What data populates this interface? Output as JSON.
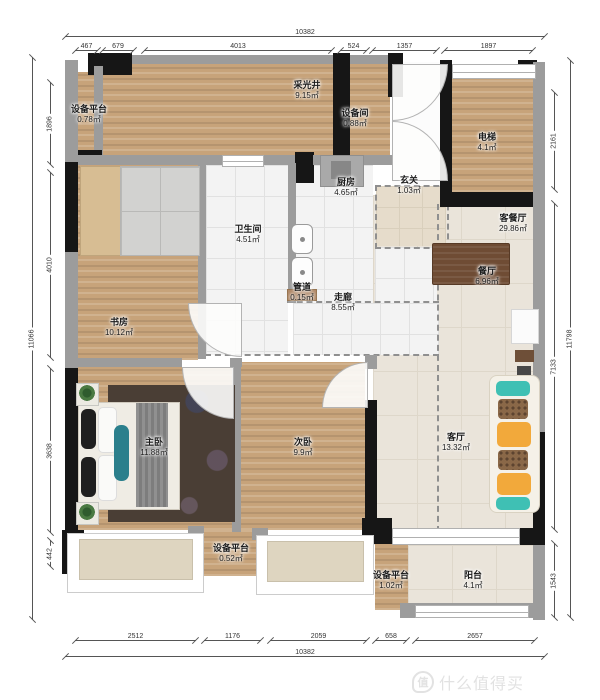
{
  "rooms": [
    {
      "key": "equip_platform_tl",
      "name": "设备平台",
      "area": "0.78㎡"
    },
    {
      "key": "light_well",
      "name": "采光井",
      "area": "9.15㎡"
    },
    {
      "key": "equip_room",
      "name": "设备间",
      "area": "0.88㎡"
    },
    {
      "key": "elevator",
      "name": "电梯",
      "area": "4.1㎡"
    },
    {
      "key": "kitchen",
      "name": "厨房",
      "area": "4.65㎡"
    },
    {
      "key": "entry",
      "name": "玄关",
      "area": "1.03㎡"
    },
    {
      "key": "bathroom",
      "name": "卫生间",
      "area": "4.51㎡"
    },
    {
      "key": "living_dining",
      "name": "客餐厅",
      "area": "29.86㎡"
    },
    {
      "key": "dining",
      "name": "餐厅",
      "area": "6.96㎡"
    },
    {
      "key": "duct",
      "name": "管道",
      "area": "0.15㎡"
    },
    {
      "key": "corridor",
      "name": "走廊",
      "area": "8.55㎡"
    },
    {
      "key": "study",
      "name": "书房",
      "area": "10.12㎡"
    },
    {
      "key": "master_bedroom",
      "name": "主卧",
      "area": "11.88㎡"
    },
    {
      "key": "second_bedroom",
      "name": "次卧",
      "area": "9.9㎡"
    },
    {
      "key": "living_room",
      "name": "客厅",
      "area": "13.32㎡"
    },
    {
      "key": "equip_platform_bottom",
      "name": "设备平台",
      "area": "0.52㎡"
    },
    {
      "key": "equip_platform_right",
      "name": "设备平台",
      "area": "1.02㎡"
    },
    {
      "key": "balcony",
      "name": "阳台",
      "area": "4.1㎡"
    }
  ],
  "dimensions": {
    "top": {
      "total": "10382",
      "segments": [
        "467",
        "679",
        "4013",
        "524",
        "1357",
        "1897"
      ]
    },
    "bottom": {
      "total": "10382",
      "segments": [
        "2512",
        "1176",
        "2059",
        "658",
        "2657"
      ]
    },
    "left": {
      "total": "11066",
      "segments": [
        "1896",
        "4010",
        "3638",
        "442"
      ]
    },
    "right": {
      "total": "11798",
      "segments": [
        "2161",
        "7133",
        "1543"
      ]
    }
  },
  "watermark": {
    "logo": "值",
    "brand": "什么值得买"
  },
  "colors": {
    "wood": "#c7a37a",
    "wall_black": "#161616",
    "wall_gray": "#9c9c9c",
    "tile_beige": "#eae4da",
    "sofa_teal": "#3fc0b4",
    "sofa_yellow": "#f2a93b",
    "rug": "#4a3e35"
  }
}
